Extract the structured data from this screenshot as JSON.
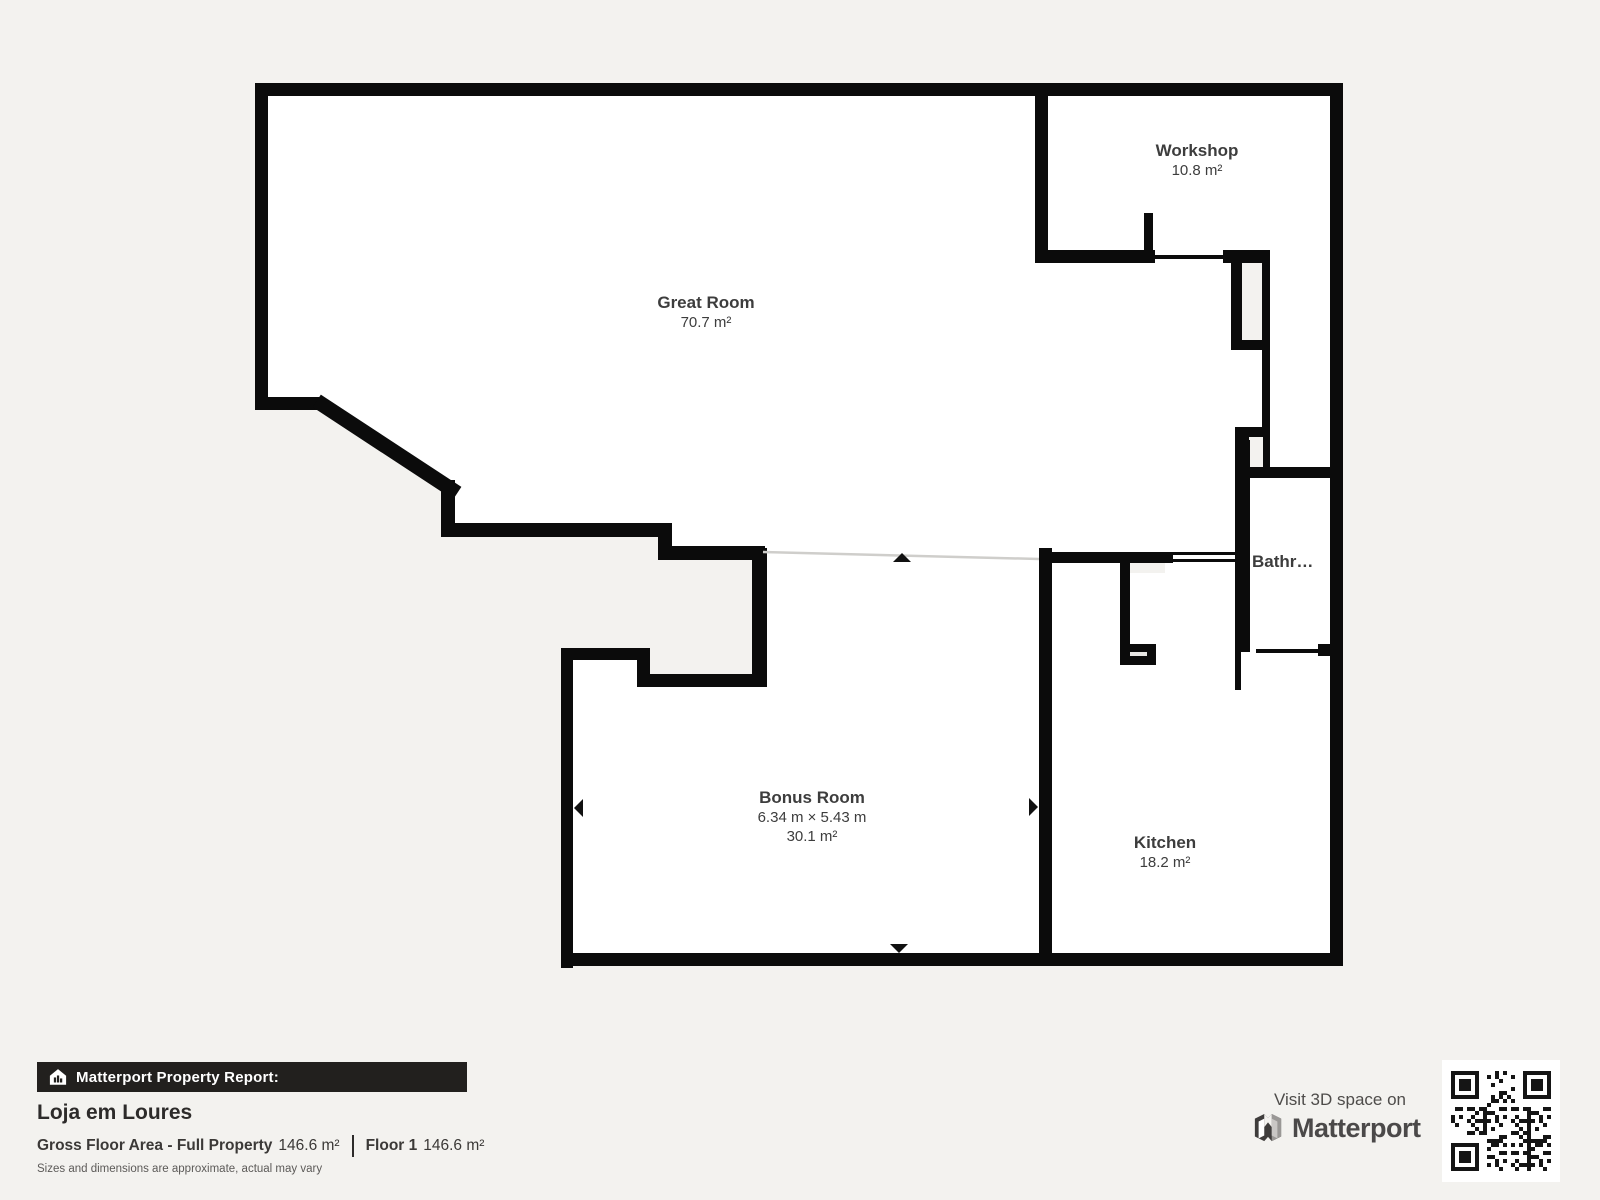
{
  "page": {
    "background": "#f3f2ef",
    "wall_color": "#0b0b0b",
    "room_fill": "#ffffff"
  },
  "floorplan": {
    "rooms": [
      {
        "name": "Great Room",
        "area": "70.7 m²"
      },
      {
        "name": "Workshop",
        "area": "10.8 m²"
      },
      {
        "name": "Bathroom"
      },
      {
        "name": "Bonus Room",
        "dimensions": "6.34 m × 5.43 m",
        "area": "30.1 m²"
      },
      {
        "name": "Kitchen",
        "area": "18.2 m²"
      }
    ]
  },
  "report": {
    "header": "Matterport Property Report:",
    "property_name": "Loja em Loures",
    "gross_label": "Gross Floor Area - Full Property",
    "gross_value": "146.6 m²",
    "floor_label": "Floor 1",
    "floor_value": "146.6 m²",
    "disclaimer": "Sizes and dimensions are approximate, actual may vary"
  },
  "cta": {
    "visit_text": "Visit 3D space on",
    "brand": "Matterport"
  }
}
